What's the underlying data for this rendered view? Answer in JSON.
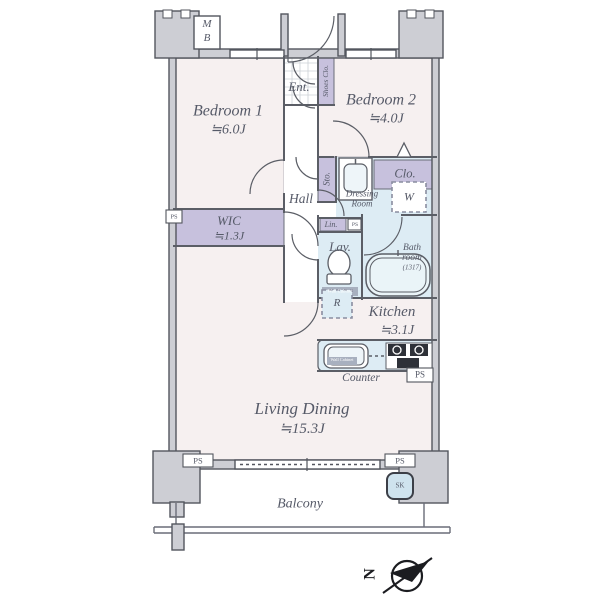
{
  "plan": {
    "bedroom1_name": "Bedroom 1",
    "bedroom1_size": "≒6.0J",
    "bedroom2_name": "Bedroom 2",
    "bedroom2_size": "≒4.0J",
    "wic_name": "WIC",
    "wic_size": "≒1.3J",
    "kitchen_name": "Kitchen",
    "kitchen_size": "≒3.1J",
    "living_name": "Living Dining",
    "living_size": "≒15.3J",
    "hall": "Hall",
    "ent": "Ent.",
    "shoes_clo": "Shoes Clo.",
    "sto": "Sto.",
    "clo": "Clo.",
    "dressing_line1": "Dressing",
    "dressing_line2": "Room",
    "washer": "W",
    "lin": "Lin.",
    "lav": "Lav.",
    "wall_cabinet": "Wall Cabinet",
    "bath_line1": "Bath",
    "bath_line2": "room",
    "bath_size": "(1317)",
    "fridge": "R",
    "counter": "Counter",
    "balcony": "Balcony",
    "mb_line1": "M",
    "mb_line2": "B",
    "sk": "SK",
    "ps": "PS",
    "compass_north": "N"
  },
  "colors": {
    "room_pink": "#f6f0f0",
    "storage_purple": "#c7c1dd",
    "wet_blue": "#ddecf4",
    "wall_gray": "#cdced4",
    "wall_line": "#53565e",
    "text": "#565a68",
    "stove_dark": "#2e3138",
    "label_strip": "#a8b0bf"
  }
}
